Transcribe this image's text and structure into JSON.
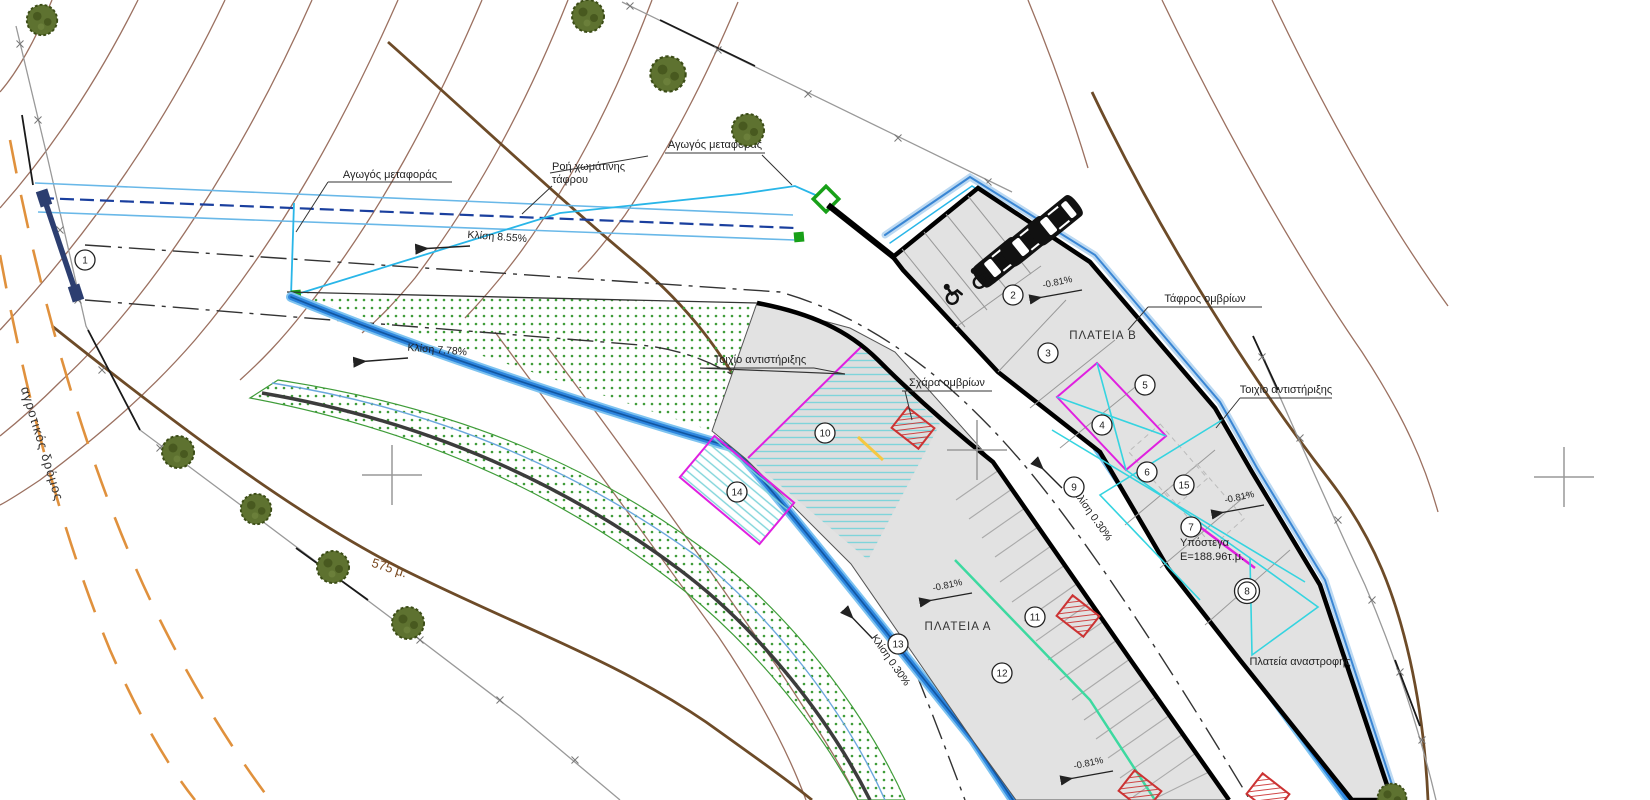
{
  "labels": {
    "pipe_transfer_left": "Αγωγός μεταφοράς",
    "pipe_transfer_right": "Αγωγός μεταφοράς",
    "earthen_ditch_flow_line1": "Ροή χωμάτινης",
    "earthen_ditch_flow_line2": "τάφρου",
    "storm_ditch": "Τάφρος ομβρίων",
    "retaining_wall_left": "Τοιχίο αντιστήριξης",
    "retaining_wall_right": "Τοιχίο αντιστήριξης",
    "storm_grate": "Σχάρα ομβρίων",
    "square_a": "ΠΛΑΤΕΙΑ Α",
    "square_b": "ΠΛΑΤΕΙΑ Β",
    "shelter_name": "Υπόστεγα",
    "shelter_area": "Ε=188.96τ.μ.",
    "turning_square": "Πλατεία αναστροφής",
    "rural_road": "αγροτικός δρόμος",
    "contour_elevation": "575 μ."
  },
  "slopes": {
    "slope_855": "Κλίση 8.55%",
    "slope_778": "Κλίση 7.78%",
    "slope_030": "Κλίση 0.30%",
    "grade_081": "-0.81%"
  },
  "markers": [
    "1",
    "2",
    "3",
    "4",
    "5",
    "6",
    "7",
    "8",
    "9",
    "10",
    "11",
    "12",
    "13",
    "14",
    "15"
  ],
  "colors": {
    "contour": "#9b7060",
    "index_contour": "#6d4b28",
    "channel_blue": "#2e86de",
    "pipe_cyan": "#29b6e8",
    "pipe_navy": "#1a3f9e",
    "vegetation_green": "#3f9c39",
    "structure_magenta": "#e020e0",
    "grate_red": "#cc3333",
    "road_orange": "#e0913d",
    "lot_gray": "#e2e2e2",
    "mint_line": "#3dd9a0",
    "survey_marker_green": "#18a018"
  }
}
